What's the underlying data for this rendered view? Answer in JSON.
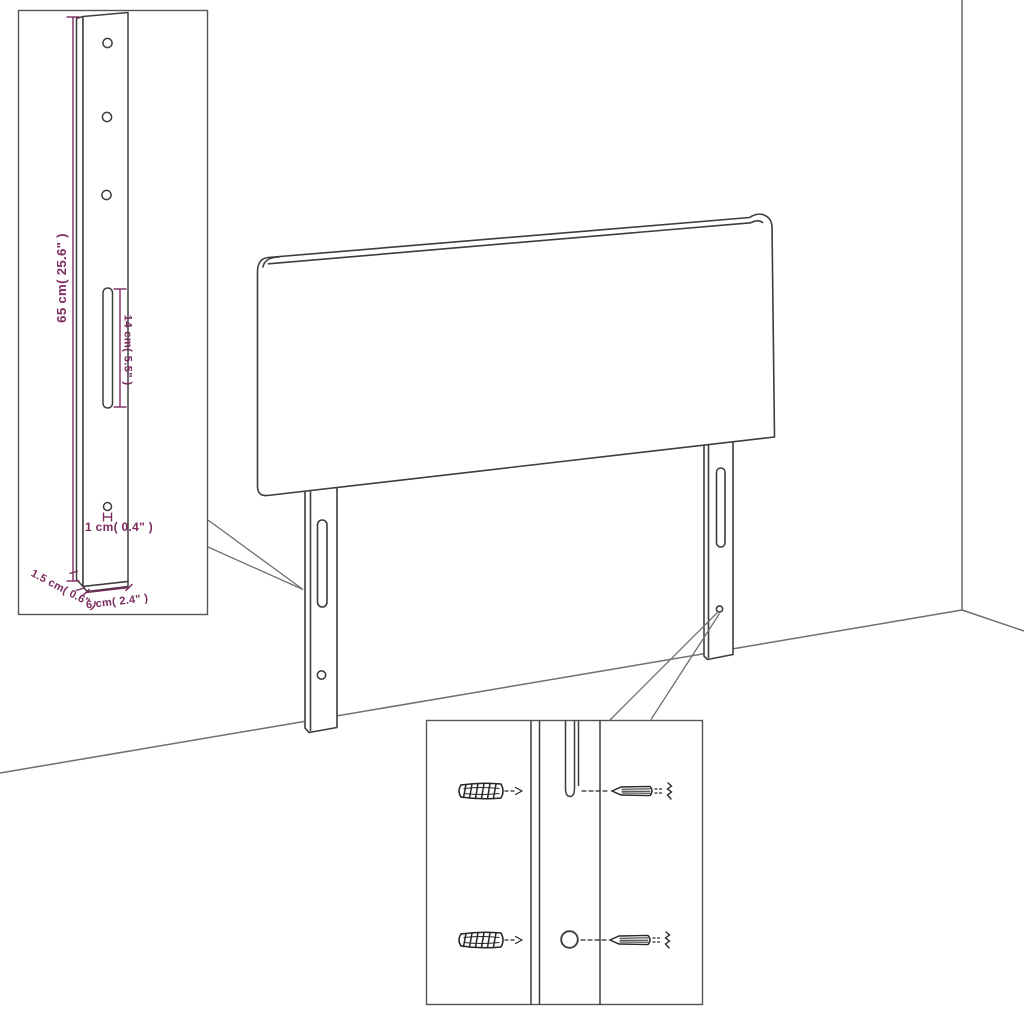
{
  "page": {
    "title": "Headboard dimensions diagram",
    "background": "#ffffff"
  },
  "colors": {
    "product_outline": "#3e3e3e",
    "room_line": "#6f6f6f",
    "callout_border": "#555555",
    "hardware_ink": "#262626",
    "dimension": "#7b2b5e"
  },
  "detail_leg": {
    "labels": {
      "height": "65 cm( 25.6\" )",
      "slot_length": "14 cm( 5.5\" )",
      "hole_offset": "1 cm( 0.4\" )",
      "thickness": "1.5 cm( 0.6\" )",
      "width": "6 cm( 2.4\" )"
    },
    "features": {
      "top_holes": 3,
      "slots": 1,
      "bottom_holes": 1
    }
  },
  "headboard": {
    "legs": 2,
    "slots_per_leg": 1,
    "holes_per_leg": 1
  },
  "mounting_detail": {
    "rows": 2,
    "hardware": [
      "wall-plug",
      "screw"
    ]
  }
}
